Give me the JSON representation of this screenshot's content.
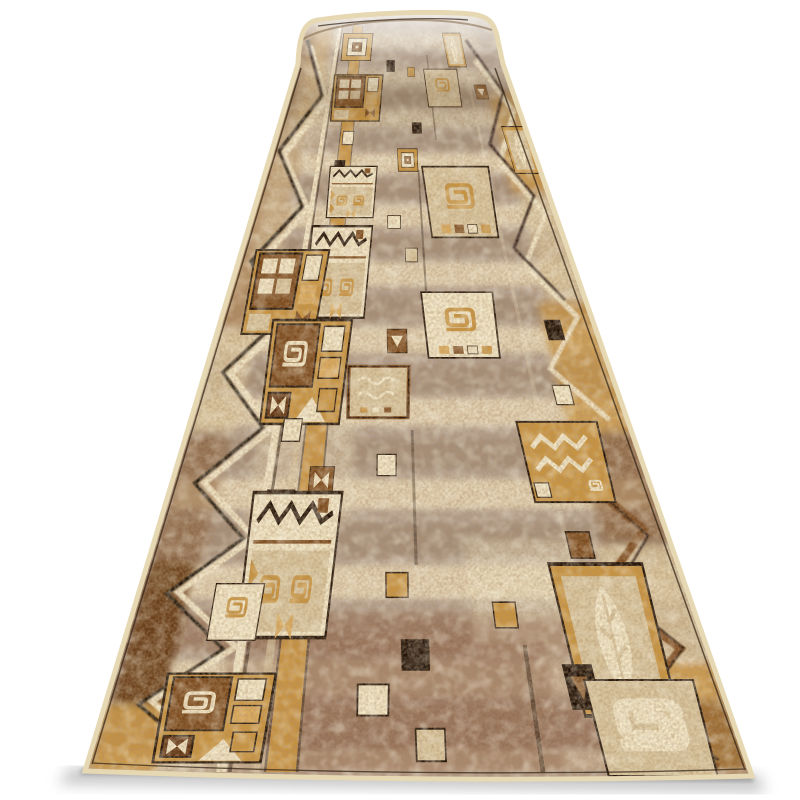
{
  "meta": {
    "alt": "Product photo of a long beige-brown patchwork carpet runner (rug) lying in perspective on a white background, far end rolled over a tube; geometric motifs: square spirals, zigzags, leaves, triangles, nested frames in cream, caramel and dark brown on a mottled taupe field"
  },
  "palette": {
    "background": "#ffffff",
    "binding": "#e6d8b2",
    "edgeDark": "#2e2013",
    "fieldBase": "#b3a08f",
    "fieldLight": "#ead9b7",
    "fieldDark": "#947b66",
    "weaveBrown": "#916b53",
    "taupe": "#aa9a8c",
    "tan2": "#b08a5e",
    "caramel": "#c9943e",
    "caramelLight": "#dcab5c",
    "wood": "#7b4a1d",
    "woodDark": "#5f3413",
    "black": "#201309",
    "cream": "#f2e7c6",
    "beige": "#d9c69e",
    "shadow": "#a6a6a6",
    "shadowDark": "#8f8f8f",
    "rollHighlight": "#ffffff",
    "rollShade": "#553815"
  },
  "rug": {
    "geometry": {
      "top": {
        "xl": 300,
        "xr": 497,
        "y": 26
      },
      "bottom": {
        "xl": 85,
        "xr": 752,
        "y": 771
      }
    },
    "streaks": [
      [
        40,
        16,
        "l"
      ],
      [
        58,
        12,
        "d"
      ],
      [
        78,
        16,
        "l"
      ],
      [
        98,
        14,
        "d"
      ],
      [
        118,
        18,
        "l"
      ],
      [
        141,
        16,
        "d"
      ],
      [
        163,
        20,
        "l"
      ],
      [
        189,
        18,
        "d"
      ],
      [
        216,
        22,
        "l"
      ],
      [
        246,
        20,
        "d"
      ],
      [
        274,
        24,
        "l"
      ],
      [
        308,
        24,
        "d"
      ],
      [
        340,
        26,
        "l"
      ],
      [
        378,
        26,
        "d"
      ],
      [
        412,
        28,
        "l"
      ],
      [
        454,
        30,
        "d"
      ],
      [
        494,
        30,
        "l"
      ],
      [
        540,
        34,
        "d"
      ],
      [
        582,
        34,
        "l"
      ],
      [
        632,
        40,
        "d"
      ],
      [
        678,
        36,
        "l"
      ],
      [
        728,
        46,
        "d"
      ],
      [
        760,
        20,
        "l"
      ]
    ],
    "patches": [
      {
        "y0": 26,
        "y1": 150,
        "u0": 0.02,
        "u1": 0.105,
        "c": "wood",
        "o": 0.95
      },
      {
        "y0": 26,
        "y1": 118,
        "u0": 0.085,
        "u1": 0.17,
        "c": "caramel",
        "o": 0.8
      },
      {
        "y0": 118,
        "y1": 330,
        "u0": 0.015,
        "u1": 0.135,
        "c": "tan2",
        "o": 0.9
      },
      {
        "y0": 150,
        "y1": 260,
        "u0": 0.05,
        "u1": 0.125,
        "c": "beige",
        "o": 0.6
      },
      {
        "y0": 330,
        "y1": 432,
        "u0": 0.015,
        "u1": 0.115,
        "c": "beige",
        "o": 0.85
      },
      {
        "y0": 432,
        "y1": 560,
        "u0": 0.012,
        "u1": 0.105,
        "c": "wood",
        "o": 0.5
      },
      {
        "y0": 560,
        "y1": 705,
        "u0": 0.01,
        "u1": 0.095,
        "c": "woodDark",
        "o": 0.9
      },
      {
        "y0": 705,
        "y1": 772,
        "u0": 0.005,
        "u1": 0.105,
        "c": "caramel",
        "o": 0.9
      },
      {
        "y0": 26,
        "y1": 112,
        "u0": 0.88,
        "u1": 0.995,
        "c": "taupe",
        "o": 0.7
      },
      {
        "y0": 92,
        "y1": 192,
        "u0": 0.865,
        "u1": 0.995,
        "c": "caramel",
        "o": 0.85
      },
      {
        "y0": 192,
        "y1": 302,
        "u0": 0.88,
        "u1": 0.995,
        "c": "beige",
        "o": 0.8
      },
      {
        "y0": 302,
        "y1": 432,
        "u0": 0.855,
        "u1": 0.995,
        "c": "caramel",
        "o": 0.8
      },
      {
        "y0": 432,
        "y1": 545,
        "u0": 0.865,
        "u1": 0.995,
        "c": "wood",
        "o": 0.55
      },
      {
        "y0": 545,
        "y1": 662,
        "u0": 0.845,
        "u1": 0.995,
        "c": "beige",
        "o": 0.85
      },
      {
        "y0": 662,
        "y1": 772,
        "u0": 0.825,
        "u1": 0.995,
        "c": "caramel",
        "o": 0.85
      },
      {
        "y0": 700,
        "y1": 772,
        "u0": 0.9,
        "u1": 0.995,
        "c": "wood",
        "o": 0.55
      },
      {
        "y0": 26,
        "y1": 150,
        "u0": 0.02,
        "u1": 0.98,
        "c": "taupe",
        "o": 0.3
      },
      {
        "y0": 60,
        "y1": 150,
        "u0": 0.05,
        "u1": 0.2,
        "c": "fieldLight",
        "o": 0.5
      },
      {
        "y0": 400,
        "y1": 520,
        "u0": 0.17,
        "u1": 0.38,
        "c": "fieldLight",
        "o": 0.5
      },
      {
        "y0": 540,
        "y1": 660,
        "u0": 0.6,
        "u1": 0.8,
        "c": "cream",
        "o": 0.45
      },
      {
        "y0": 620,
        "y1": 772,
        "u0": 0.18,
        "u1": 0.8,
        "c": "weaveBrown",
        "o": 0.4
      },
      {
        "y0": 640,
        "y1": 772,
        "u0": 0.3,
        "u1": 0.72,
        "c": "weaveBrown",
        "o": 0.55
      }
    ],
    "stripes": [
      {
        "u0": 0.197,
        "u1": 0.212,
        "y0": 26,
        "y1": 772,
        "c": "cream",
        "o": 0.95
      },
      {
        "u0": 0.214,
        "u1": 0.22,
        "y0": 26,
        "y1": 772,
        "c": "black",
        "o": 0.55
      },
      {
        "u0": 0.268,
        "u1": 0.272,
        "y0": 26,
        "y1": 772,
        "c": "black",
        "o": 0.5
      },
      {
        "u0": 0.272,
        "u1": 0.316,
        "y0": 26,
        "y1": 772,
        "c": "caramel",
        "o": 0.95
      },
      {
        "u0": 0.316,
        "u1": 0.32,
        "y0": 26,
        "y1": 772,
        "c": "black",
        "o": 0.5
      },
      {
        "u0": 0.248,
        "u1": 0.262,
        "y0": 300,
        "y1": 772,
        "c": "beige",
        "o": 0.6
      },
      {
        "u0": 0.553,
        "u1": 0.559,
        "y0": 170,
        "y1": 335,
        "c": "black",
        "o": 0.45
      },
      {
        "u0": 0.503,
        "u1": 0.509,
        "y0": 430,
        "y1": 565,
        "c": "black",
        "o": 0.4
      },
      {
        "u0": 0.683,
        "u1": 0.69,
        "y0": 645,
        "y1": 772,
        "c": "black",
        "o": 0.5
      },
      {
        "u0": 0.625,
        "u1": 0.631,
        "y0": 55,
        "y1": 140,
        "c": "black",
        "o": 0.4
      },
      {
        "u0": 0.79,
        "u1": 0.8,
        "y0": 26,
        "y1": 772,
        "c": "cream",
        "o": 0.25
      }
    ],
    "zigzags": [
      {
        "uA": 0.075,
        "uB": 0.195,
        "y0": 46,
        "y1": 756,
        "n": 13,
        "c": "cream",
        "w": 6,
        "o": 0.95
      },
      {
        "uA": 0.055,
        "uB": 0.175,
        "y0": 40,
        "y1": 760,
        "n": 13,
        "c": "black",
        "w": 3.5,
        "o": 0.95
      },
      {
        "uA": 0.845,
        "uB": 0.95,
        "y0": 60,
        "y1": 420,
        "n": 7,
        "c": "cream",
        "w": 5,
        "o": 0.9
      },
      {
        "uA": 0.825,
        "uB": 0.93,
        "y0": 40,
        "y1": 300,
        "n": 5,
        "c": "black",
        "w": 3,
        "o": 0.85
      },
      {
        "uA": 0.84,
        "uB": 0.95,
        "y0": 470,
        "y1": 768,
        "n": 5,
        "c": "wood",
        "w": 8,
        "o": 0.95
      },
      {
        "uA": 0.862,
        "uB": 0.955,
        "y0": 480,
        "y1": 760,
        "n": 5,
        "c": "black",
        "w": 2.5,
        "o": 0.8
      }
    ],
    "motifs": [
      {
        "type": "framesSq",
        "y": 47,
        "u": 0.3,
        "w": 0.14,
        "h": 0.13
      },
      {
        "type": "leafRect",
        "y": 50,
        "u": 0.76,
        "w": 0.085,
        "h": 0.16,
        "flag": false
      },
      {
        "type": "spiralSq",
        "y": 88,
        "u": 0.68,
        "w": 0.14,
        "h": 0.16,
        "base": "beige",
        "dots": false
      },
      {
        "type": "windowSq",
        "y": 98,
        "u": 0.32,
        "w": 0.2,
        "h": 0.19
      },
      {
        "type": "dot",
        "y": 66,
        "u": 0.46,
        "w": 0.035,
        "h": 0.05,
        "color": "black"
      },
      {
        "type": "dot",
        "y": 72,
        "u": 0.55,
        "w": 0.03,
        "h": 0.04,
        "color": "caramel"
      },
      {
        "type": "chevronSq",
        "y": 92,
        "u": 0.84,
        "w": 0.05,
        "h": 0.06,
        "base": "wood",
        "accent": "cream"
      },
      {
        "type": "leafRect",
        "y": 150,
        "u": 0.93,
        "w": 0.085,
        "h": 0.17,
        "flag": false
      },
      {
        "type": "dot",
        "y": 128,
        "u": 0.56,
        "w": 0.035,
        "h": 0.04,
        "color": "black"
      },
      {
        "type": "dot",
        "y": 138,
        "u": 0.3,
        "w": 0.04,
        "h": 0.05,
        "color": "cream"
      },
      {
        "type": "dot",
        "y": 167,
        "u": 0.28,
        "w": 0.035,
        "h": 0.045,
        "color": "black"
      },
      {
        "type": "framesSq",
        "y": 160,
        "u": 0.52,
        "w": 0.07,
        "h": 0.08
      },
      {
        "type": "creamZigzag",
        "y": 192,
        "u": 0.33,
        "w": 0.155,
        "h": 0.17
      },
      {
        "type": "spiralSq",
        "y": 202,
        "u": 0.685,
        "w": 0.215,
        "h": 0.23,
        "base": "beige",
        "dots": true
      },
      {
        "type": "dot",
        "y": 222,
        "u": 0.47,
        "w": 0.04,
        "h": 0.04,
        "color": "cream"
      },
      {
        "type": "dot",
        "y": 240,
        "u": 0.25,
        "w": 0.04,
        "h": 0.05,
        "color": "cream"
      },
      {
        "type": "dot",
        "y": 255,
        "u": 0.52,
        "w": 0.035,
        "h": 0.04,
        "color": "beige"
      },
      {
        "type": "creamZigzag",
        "y": 272,
        "u": 0.31,
        "w": 0.17,
        "h": 0.26
      },
      {
        "type": "windowSq",
        "y": 292,
        "u": 0.17,
        "w": 0.2,
        "h": 0.23
      },
      {
        "type": "spiralSq",
        "y": 325,
        "u": 0.64,
        "w": 0.185,
        "h": 0.17,
        "base": "cream",
        "dots": true
      },
      {
        "type": "dot",
        "y": 330,
        "u": 0.88,
        "w": 0.04,
        "h": 0.05,
        "color": "black"
      },
      {
        "type": "chevronSq",
        "y": 341,
        "u": 0.475,
        "w": 0.05,
        "h": 0.06,
        "base": "wood",
        "accent": "cream"
      },
      {
        "type": "panelSpiral",
        "y": 372,
        "u": 0.255,
        "w": 0.19,
        "h": 0.25
      },
      {
        "type": "wavyRect",
        "y": 392,
        "u": 0.43,
        "w": 0.14,
        "h": 0.12
      },
      {
        "type": "dot",
        "y": 395,
        "u": 0.86,
        "w": 0.04,
        "h": 0.045,
        "color": "cream"
      },
      {
        "type": "dot",
        "y": 430,
        "u": 0.24,
        "w": 0.04,
        "h": 0.05,
        "color": "cream"
      },
      {
        "type": "zigCaramel",
        "y": 462,
        "u": 0.83,
        "w": 0.17,
        "h": 0.17
      },
      {
        "type": "dot",
        "y": 465,
        "u": 0.45,
        "w": 0.04,
        "h": 0.045,
        "color": "cream"
      },
      {
        "type": "bowtieSq",
        "y": 480,
        "u": 0.315,
        "w": 0.05,
        "h": 0.055,
        "base": "wood",
        "accent": "cream"
      },
      {
        "type": "chevronSq",
        "y": 505,
        "u": 0.235,
        "w": 0.055,
        "h": 0.06,
        "base": "wood",
        "accent": "cream"
      },
      {
        "type": "dot",
        "y": 530,
        "u": 0.215,
        "w": 0.04,
        "h": 0.05,
        "color": "black"
      },
      {
        "type": "dot",
        "y": 545,
        "u": 0.82,
        "w": 0.045,
        "h": 0.05,
        "color": "wood"
      },
      {
        "type": "creamZigzag",
        "y": 565,
        "u": 0.27,
        "w": 0.165,
        "h": 0.27
      },
      {
        "type": "dot",
        "y": 585,
        "u": 0.47,
        "w": 0.04,
        "h": 0.045,
        "color": "caramel"
      },
      {
        "type": "spiralSq",
        "y": 612,
        "u": 0.185,
        "w": 0.085,
        "h": 0.1,
        "base": "cream",
        "dots": false
      },
      {
        "type": "dot",
        "y": 615,
        "u": 0.66,
        "w": 0.04,
        "h": 0.045,
        "color": "caramel"
      },
      {
        "type": "leafRect",
        "y": 640,
        "u": 0.84,
        "w": 0.16,
        "h": 0.26,
        "flag": true
      },
      {
        "type": "dot",
        "y": 655,
        "u": 0.5,
        "w": 0.045,
        "h": 0.05,
        "color": "black"
      },
      {
        "type": "dot",
        "y": 700,
        "u": 0.43,
        "w": 0.05,
        "h": 0.05,
        "color": "cream"
      },
      {
        "type": "panelSpiral",
        "y": 718,
        "u": 0.18,
        "w": 0.17,
        "h": 0.14
      },
      {
        "type": "bigSpiralCream",
        "y": 728,
        "u": 0.865,
        "w": 0.17,
        "h": 0.15
      },
      {
        "type": "dot",
        "y": 745,
        "u": 0.52,
        "w": 0.045,
        "h": 0.05,
        "color": "beige"
      }
    ],
    "shadow": {
      "main": [
        [
          70,
          768
        ],
        [
          758,
          775
        ],
        [
          766,
          792
        ],
        [
          58,
          784
        ]
      ],
      "tight": [
        [
          82,
          768
        ],
        [
          752,
          775
        ],
        [
          754,
          782
        ],
        [
          80,
          775
        ]
      ]
    }
  }
}
